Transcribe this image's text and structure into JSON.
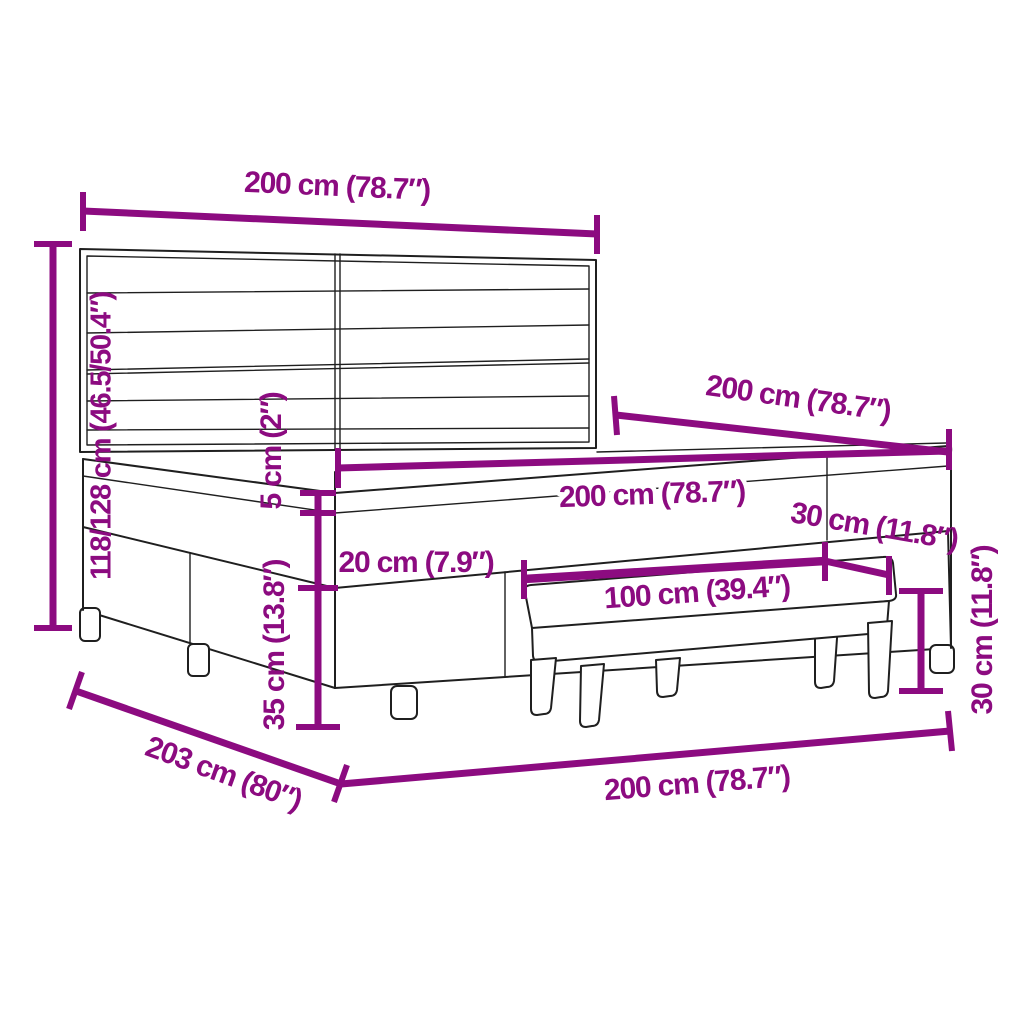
{
  "diagram": {
    "kind": "furniture-dimension-diagram",
    "subject": "box spring bed with striped headboard and footstool bench",
    "colors": {
      "dimension": "#8C0B80",
      "outline": "#1f1f1f",
      "background": "#ffffff"
    },
    "labels": {
      "headboard_width": "200 cm (78.7″)",
      "bed_height": "118/128 cm (46.5/50.4″)",
      "bed_length": "200 cm (78.7″)",
      "mattress_width": "200 cm (78.7″)",
      "topper_thickness": "5 cm (2″)",
      "mattress_thickness": "20 cm (7.9″)",
      "base_height": "35 cm (13.8″)",
      "frame_length": "203 cm (80″)",
      "frame_width": "200 cm (78.7″)",
      "bench_length": "100 cm (39.4″)",
      "bench_depth": "30 cm (11.8″)",
      "bench_height": "30 cm (11.8″)"
    }
  }
}
